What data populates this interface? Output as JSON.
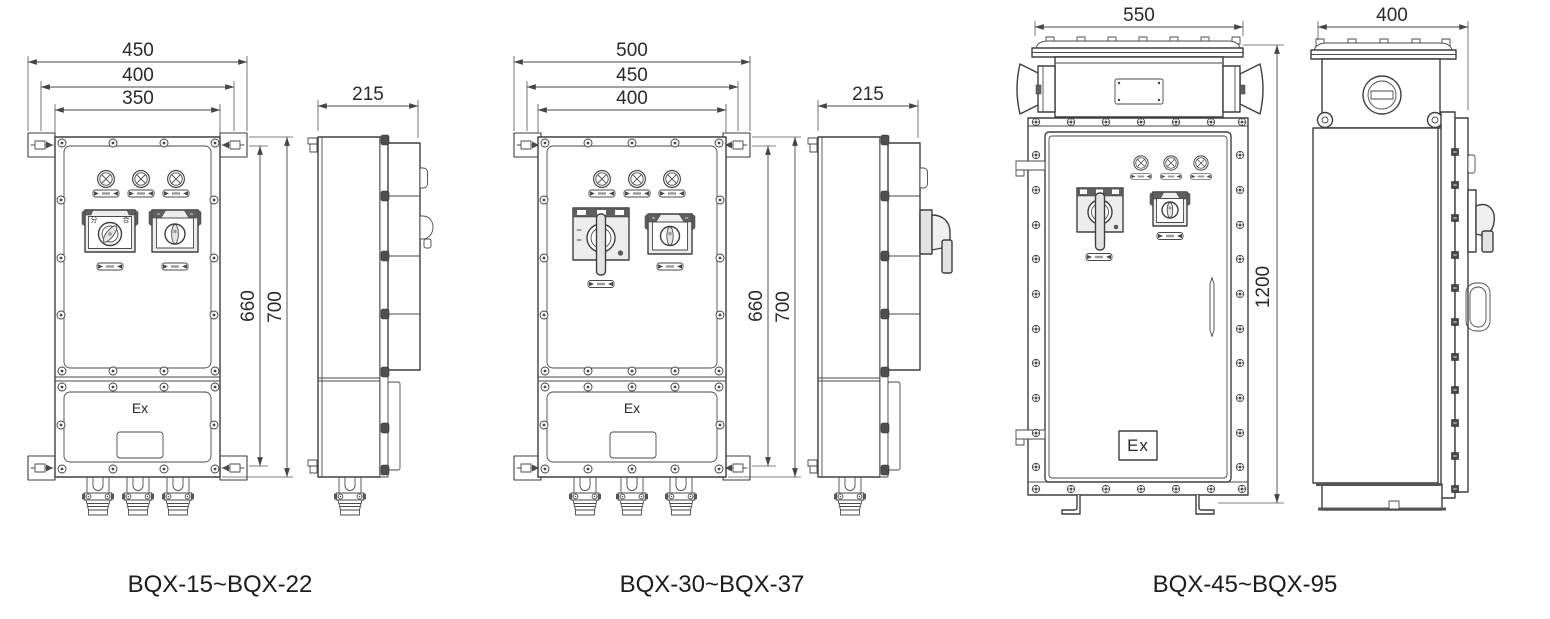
{
  "drawings": [
    {
      "caption": "BQX-15~BQX-22",
      "front_view": {
        "dim_overall_width": "450",
        "dim_mount_width": "400",
        "dim_body_width": "350",
        "dim_mount_height": "660",
        "dim_overall_height": "700",
        "ex_marking": "Ex",
        "switch_labels": {
          "open": "分",
          "close": "合"
        }
      },
      "side_view": {
        "dim_depth": "215"
      }
    },
    {
      "caption": "BQX-30~BQX-37",
      "front_view": {
        "dim_overall_width": "500",
        "dim_mount_width": "450",
        "dim_body_width": "400",
        "dim_mount_height": "660",
        "dim_overall_height": "700",
        "ex_marking": "Ex"
      },
      "side_view": {
        "dim_depth": "215"
      }
    },
    {
      "caption": "BQX-45~BQX-95",
      "front_view": {
        "dim_overall_width": "550",
        "dim_overall_height": "1200",
        "ex_marking": "Ex"
      },
      "side_view": {
        "dim_depth": "400"
      }
    }
  ]
}
